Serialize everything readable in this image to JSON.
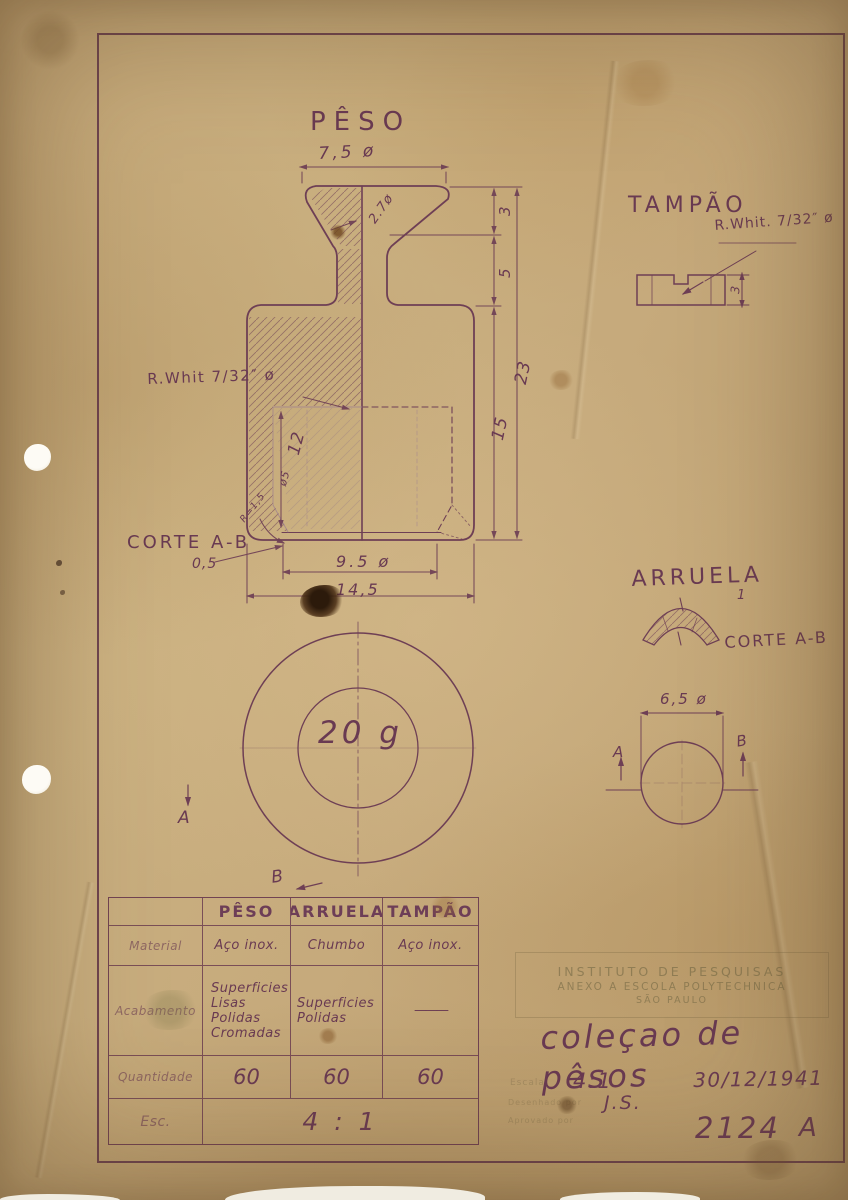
{
  "colors": {
    "ink": "#6e3f55",
    "paper": "#c6aa7c"
  },
  "peso": {
    "title": "PÊSO",
    "dim_top_diameter": "7,5 ø",
    "dim_neck_diameter": "2.7ø",
    "dim_cap_height": "3",
    "dim_step_height": "5",
    "dim_body_height": "15",
    "dim_total_height": "23",
    "thread_label": "R.Whit 7/32″ ø",
    "dim_cavity_height": "12",
    "dim_cavity_diameter": "ø5",
    "corner_radius": "R=1,5",
    "section_label": "CORTE A-B",
    "dim_lip": "0,5",
    "dim_opening": "9.5 ø",
    "dim_base": "14,5",
    "mass_label": "20 g",
    "section_a": "A",
    "section_b": "B"
  },
  "tampao": {
    "title": "TAMPÃO",
    "thread_label": "R.Whit. 7/32″ ø",
    "dim_height": "3"
  },
  "arruela": {
    "title": "ARRUELA",
    "dim_thickness": "1",
    "section_label": "CORTE A-B",
    "dim_diameter": "6,5 ø",
    "section_a": "A",
    "section_b": "B"
  },
  "table": {
    "col_headers": [
      "PÊSO",
      "ARRUELA",
      "TAMPÃO"
    ],
    "material": {
      "label": "Material",
      "cells": [
        "Aço inox.",
        "Chumbo",
        "Aço inox."
      ]
    },
    "finish": {
      "label": "Acabamento",
      "cells": [
        "Superficies\nLisas\nPolidas\nCromadas",
        "Superficies\nPolidas",
        "———"
      ]
    },
    "quantity": {
      "label": "Quantidade",
      "cells": [
        "60",
        "60",
        "60"
      ]
    },
    "scale": {
      "label": "Esc.",
      "value": "4 : 1"
    }
  },
  "title_block": {
    "stamp_line1": "INSTITUTO DE PESQUISAS",
    "stamp_line2": "ANEXO A ESCOLA POLYTECHNICA",
    "stamp_line3": "SÃO PAULO",
    "title": "coleçao de pêsos",
    "form_scale_label": "Escala",
    "scale": "4:1",
    "date": "30/12/1941",
    "form_author_label": "Desenhado por",
    "form_approved_label": "Aprovado por",
    "author": "J.S.",
    "number": "2124",
    "revision": "A"
  }
}
